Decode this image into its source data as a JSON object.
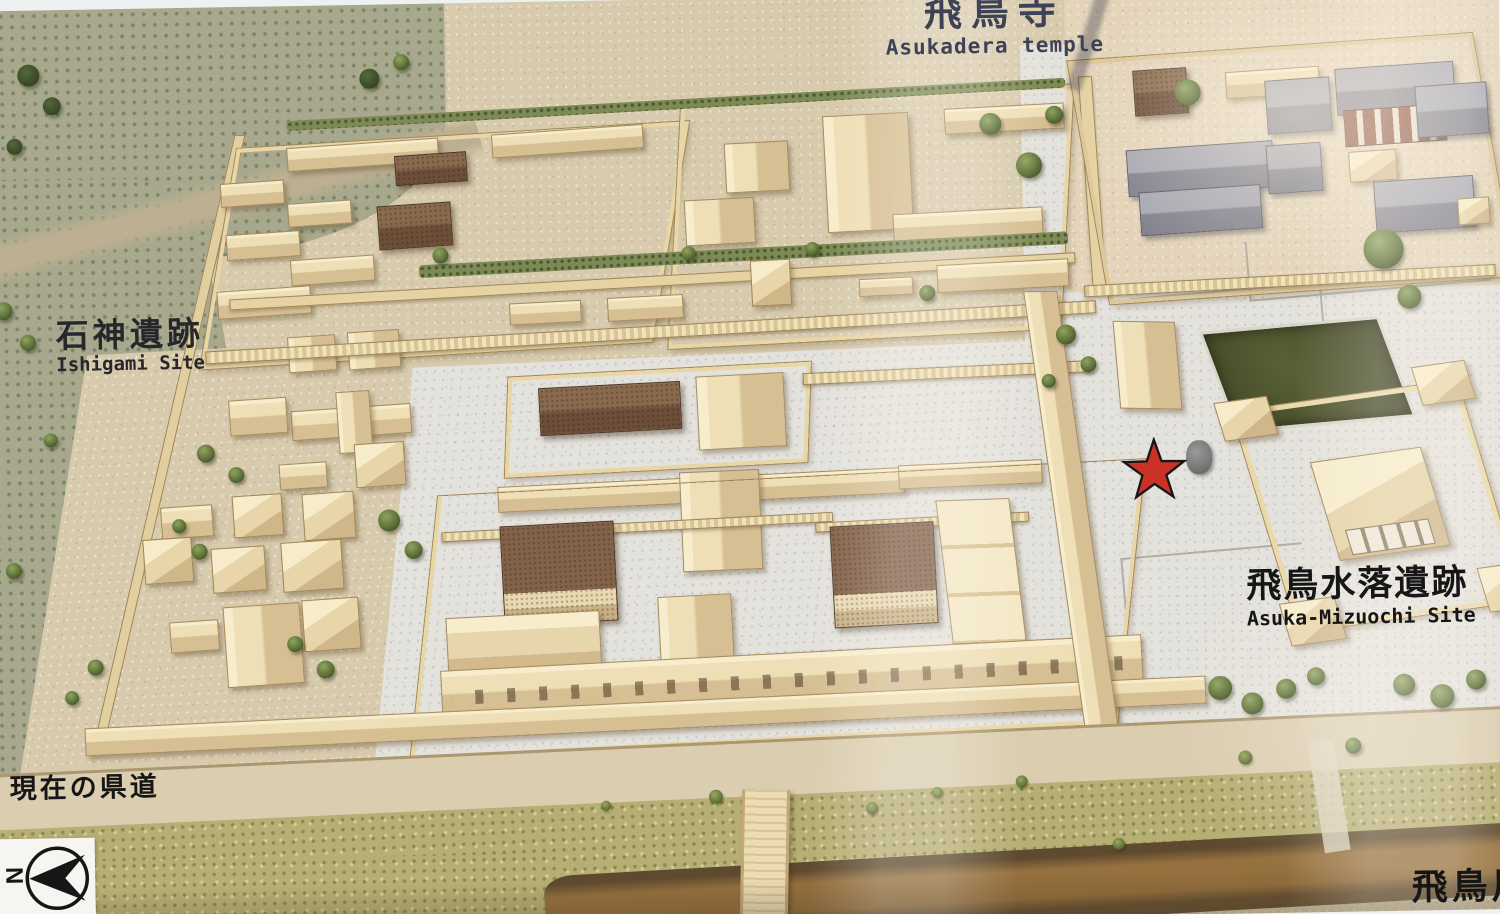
{
  "photo_labels": {
    "asukadera": {
      "ja": "飛鳥寺",
      "en": "Asukadera temple"
    },
    "ishigami": {
      "ja": "石神遺跡",
      "en": "Ishigami Site"
    },
    "mizuochi": {
      "ja": "飛鳥水落遺跡",
      "en": "Asuka-Mizuochi Site"
    },
    "current_road": {
      "ja": "現在の県道"
    },
    "asuka_river": {
      "ja": "飛鳥川"
    }
  },
  "compass": {
    "letter": "N"
  },
  "marker": {
    "type": "star",
    "color": "#cb3227",
    "outline": "#161616"
  },
  "colors": {
    "label_navy": "#3d4257",
    "label_black": "#161616",
    "pond_green": "#4a5130",
    "river_brown": "#8b6a3e",
    "roof_tan": "#eedfb6",
    "roof_brown": "#6d4f39",
    "roof_gray": "#8a8a96",
    "gravel": "#e4e2dc"
  }
}
